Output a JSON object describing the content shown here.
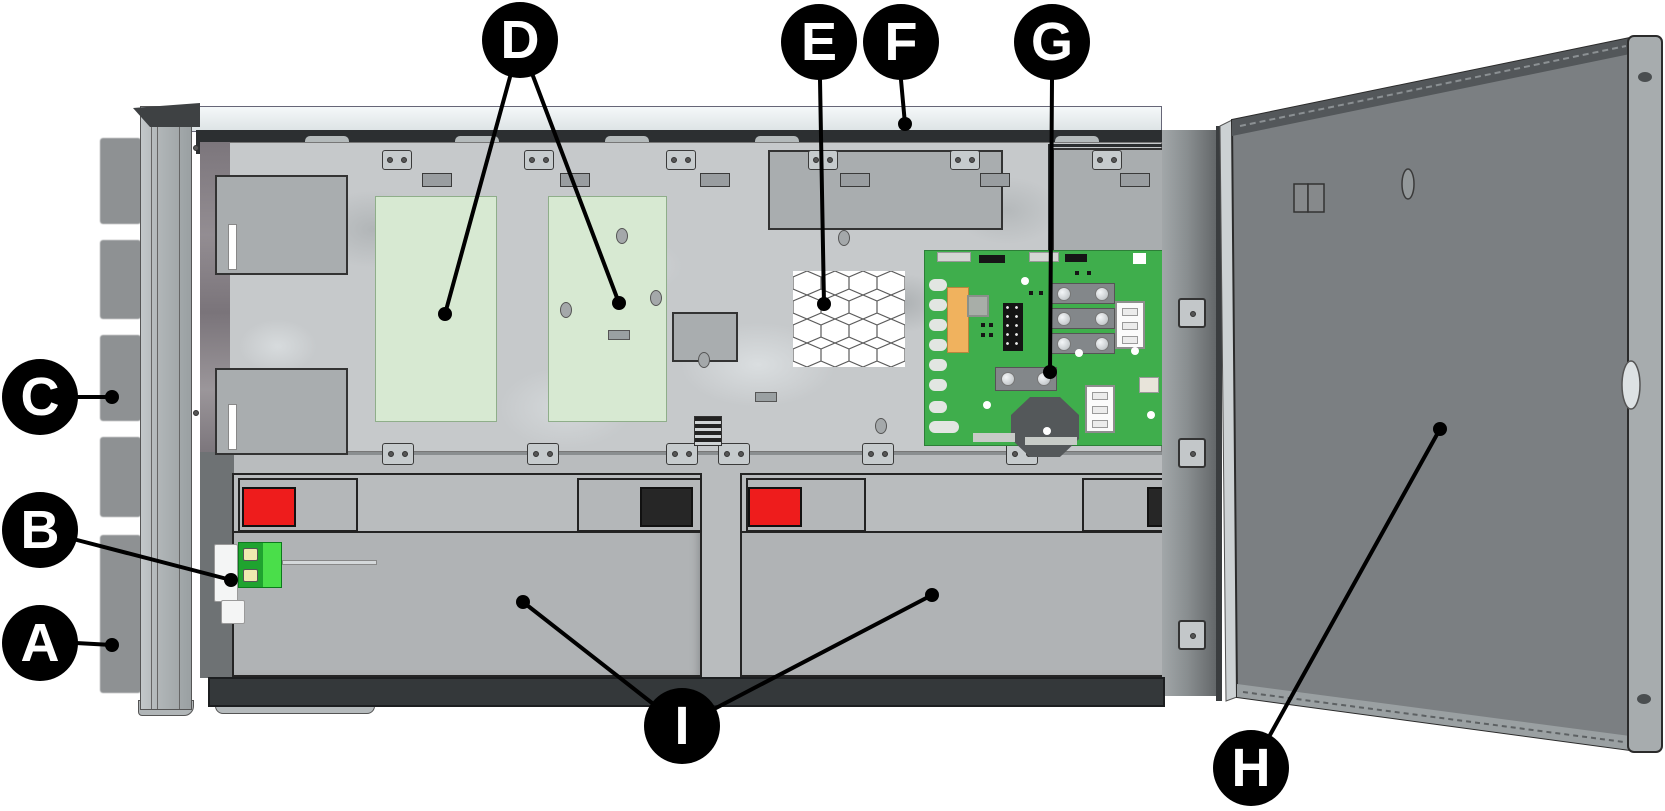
{
  "diagram": {
    "callouts": [
      {
        "label": "A"
      },
      {
        "label": "B"
      },
      {
        "label": "C"
      },
      {
        "label": "D"
      },
      {
        "label": "E"
      },
      {
        "label": "F"
      },
      {
        "label": "G"
      },
      {
        "label": "H"
      },
      {
        "label": "I"
      }
    ]
  },
  "colors": {
    "callout-bg": "#000000",
    "callout-text": "#ffffff",
    "pcb-green": "#3fae4c",
    "module-area-green": "#d7e9d2",
    "module-area-border": "#8fae8a",
    "battery-red-cover": "#ee1c1c",
    "battery-black-cover": "#262626",
    "terminal-green-dark": "#1fa32f",
    "terminal-green-bright": "#4ade4a",
    "door-gray": "#7b7f82",
    "panel-gray": "#c6c9cb",
    "battery-gray": "#b0b3b5"
  }
}
